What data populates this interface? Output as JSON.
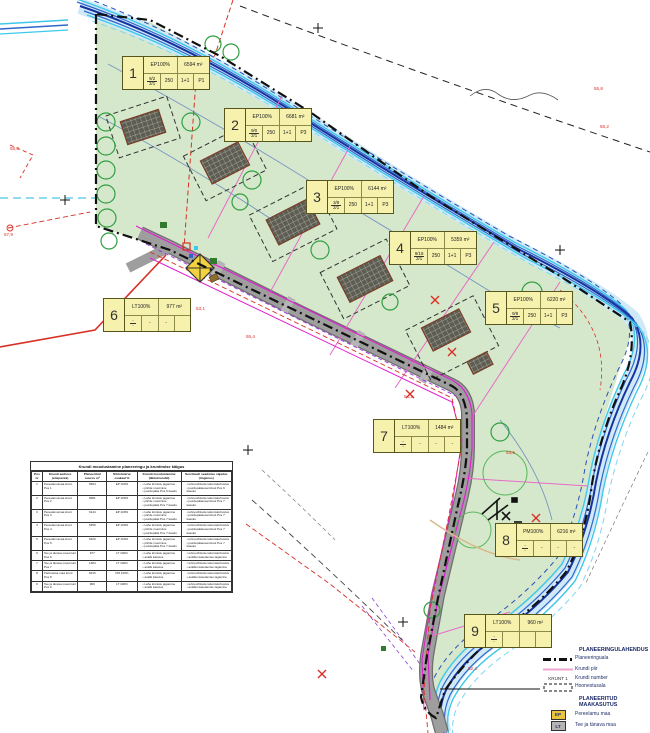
{
  "map": {
    "plots": [
      {
        "num": "1",
        "use": "EP100%",
        "area": "6594 m²",
        "f_top": "9/2",
        "f_bot": "2/1",
        "c1": "250",
        "c2": "1+1",
        "c3": "P1",
        "x": 122,
        "y": 56
      },
      {
        "num": "2",
        "use": "EP100%",
        "area": "6681 m²",
        "f_top": "9/0",
        "f_bot": "2/1",
        "c1": "250",
        "c2": "1+1",
        "c3": "P3",
        "x": 224,
        "y": 108
      },
      {
        "num": "3",
        "use": "EP100%",
        "area": "6144 m²",
        "f_top": "3/8",
        "f_bot": "2/1",
        "c1": "250",
        "c2": "1+1",
        "c3": "P3",
        "x": 306,
        "y": 180
      },
      {
        "num": "4",
        "use": "EP100%",
        "area": "5359 m²",
        "f_top": "9/18",
        "f_bot": "2/1",
        "c1": "250",
        "c2": "1+1",
        "c3": "P3",
        "x": 389,
        "y": 231
      },
      {
        "num": "5",
        "use": "EP100%",
        "area": "6220 m²",
        "f_top": "9/8",
        "f_bot": "2/1",
        "c1": "250",
        "c2": "1+1",
        "c3": "P3",
        "x": 485,
        "y": 291
      },
      {
        "num": "6",
        "use": "LT100%",
        "area": "977 m²",
        "f_top": "-",
        "f_bot": "-",
        "c1": "-",
        "c2": "-",
        "c3": "",
        "x": 103,
        "y": 298
      },
      {
        "num": "7",
        "use": "LT100%",
        "area": "1484 m²",
        "f_top": "-",
        "f_bot": "-",
        "c1": "-",
        "c2": "-",
        "c3": "-",
        "x": 373,
        "y": 419
      },
      {
        "num": "8",
        "use": "PM100%",
        "area": "6216 m²",
        "f_top": "-",
        "f_bot": "-",
        "c1": "-",
        "c2": "-",
        "c3": "-",
        "x": 495,
        "y": 523
      },
      {
        "num": "9",
        "use": "LT100%",
        "area": "960 m²",
        "f_top": "-",
        "f_bot": "-",
        "c1": "",
        "c2": "",
        "c3": "",
        "x": 464,
        "y": 614
      }
    ]
  },
  "table": {
    "title": "Krundi moodustamine planeeringu ja kruntimise käigus",
    "columns": [
      "Pos nr",
      "Krundi aadress (ettepanek)",
      "Planeeritud suurus m²",
      "Sihtotstarve osakaal %",
      "Krundi moodustamine (lähtekrundid)",
      "Servituudi seadmise vajadus (tingimus)"
    ],
    "rows": [
      {
        "pos": "1",
        "aadress": "Pereelamumaa krunt Pos 1",
        "suurus": "6594",
        "siht": "EP 100%",
        "moodustamine": [
          "Lahe kinnistu jagamine",
          "piiride muutmine",
          "juurdepääs Pos 6 kaudu"
        ],
        "servituut": [
          "tehnovõrkude talumiskohustus",
          "juurdepääsuservituut Pos 6 kasuks"
        ]
      },
      {
        "pos": "2",
        "aadress": "Pereelamumaa krunt Pos 2",
        "suurus": "6681",
        "siht": "EP 100%",
        "moodustamine": [
          "Lahe kinnistu jagamine",
          "piiride muutmine",
          "juurdepääs Pos 7 kaudu"
        ],
        "servituut": [
          "tehnovõrkude talumiskohustus",
          "juurdepääsuservituut Pos 7 kasuks"
        ]
      },
      {
        "pos": "3",
        "aadress": "Pereelamumaa krunt Pos 3",
        "suurus": "6144",
        "siht": "EP 100%",
        "moodustamine": [
          "Lahe kinnistu jagamine",
          "piiride muutmine",
          "juurdepääs Pos 7 kaudu"
        ],
        "servituut": [
          "tehnovõrkude talumiskohustus",
          "juurdepääsuservituut Pos 7 kasuks"
        ]
      },
      {
        "pos": "4",
        "aadress": "Pereelamumaa krunt Pos 4",
        "suurus": "5359",
        "siht": "EP 100%",
        "moodustamine": [
          "Lahe kinnistu jagamine",
          "piiride muutmine",
          "juurdepääs Pos 7 kaudu"
        ],
        "servituut": [
          "tehnovõrkude talumiskohustus",
          "juurdepääsuservituut Pos 7 kasuks"
        ]
      },
      {
        "pos": "5",
        "aadress": "Pereelamumaa krunt Pos 5",
        "suurus": "6220",
        "siht": "EP 100%",
        "moodustamine": [
          "Lahe kinnistu jagamine",
          "piiride muutmine",
          "juurdepääs Pos 7 kaudu"
        ],
        "servituut": [
          "tehnovõrkude talumiskohustus",
          "juurdepääsuservituut Pos 7 kasuks"
        ]
      },
      {
        "pos": "6",
        "aadress": "Tee ja tänava maa krunt Pos 6",
        "suurus": "977",
        "siht": "LT 100%",
        "moodustamine": [
          "Lahe kinnistu jagamine",
          "avalik kasutus"
        ],
        "servituut": [
          "tehnovõrkude talumiskohustus",
          "avaliku kasutamise tagamine"
        ]
      },
      {
        "pos": "7",
        "aadress": "Tee ja tänava maa krunt Pos 7",
        "suurus": "1484",
        "siht": "LT 100%",
        "moodustamine": [
          "Lahe kinnistu jagamine",
          "avalik kasutus"
        ],
        "servituut": [
          "tehnovõrkude talumiskohustus",
          "avaliku kasutamise tagamine"
        ]
      },
      {
        "pos": "8",
        "aadress": "Parkmetsa maa krunt Pos 8",
        "suurus": "6216",
        "siht": "PM 100%",
        "moodustamine": [
          "Lahe kinnistu jagamine",
          "avalik kasutus"
        ],
        "servituut": [
          "tehnovõrkude talumiskohustus",
          "avaliku kasutamise tagamine"
        ]
      },
      {
        "pos": "9",
        "aadress": "Tee ja tänava maa krunt Pos 9",
        "suurus": "960",
        "siht": "LT 100%",
        "moodustamine": [
          "Lahe kinnistu jagamine",
          "avalik kasutus"
        ],
        "servituut": [
          "tehnovõrkude talumiskohustus",
          "avaliku kasutamise tagamine"
        ]
      }
    ]
  },
  "legend": {
    "section1": {
      "title": "PLANEERINGULAHENDUS",
      "items": [
        {
          "symbol": "boundary-line",
          "label": "Planeeringuala"
        },
        {
          "symbol": "plot-line",
          "label": "Krundi piir"
        },
        {
          "symbol": "krunt-text",
          "symbol_text": "KRUNT 1",
          "label": "Krundi number"
        },
        {
          "symbol": "building-area",
          "label": "Hoonestusala"
        }
      ]
    },
    "section2": {
      "title": "PLANEERITUD MAAKASUTUS",
      "items": [
        {
          "code": "EP",
          "color": "#e8c33c",
          "label": "Pereelamu maa"
        },
        {
          "code": "LT",
          "color": "#b4b4b4",
          "label": "Tee ja tänava maa"
        },
        {
          "code": "PM",
          "color": "#2f9e41",
          "label": "Parkmetsa maa"
        }
      ]
    }
  },
  "annotations": [
    {
      "x": 10,
      "y": 146,
      "text": "58,3"
    },
    {
      "x": 4,
      "y": 232,
      "text": "57,9"
    },
    {
      "x": 594,
      "y": 86,
      "text": "55,8"
    },
    {
      "x": 600,
      "y": 124,
      "text": "56,2"
    },
    {
      "x": 246,
      "y": 334,
      "text": "55,4"
    },
    {
      "x": 196,
      "y": 306,
      "text": "53,1"
    },
    {
      "x": 404,
      "y": 394,
      "text": "54,2"
    },
    {
      "x": 506,
      "y": 450,
      "text": "53,6"
    },
    {
      "x": 468,
      "y": 666,
      "text": "52,4"
    }
  ],
  "colors": {
    "plan_area_green": "#d6e8cc",
    "stream_cyan": "#3ec8ea",
    "stream_blue": "#2f66cc",
    "stream_navy": "#16329e",
    "road_gray": "#9e9e9e",
    "plot_line_pink": "#e86ac8",
    "utility_magenta": "#e020d0",
    "annotation_red": "#d93025",
    "label_yellow": "#f6f1ad"
  }
}
